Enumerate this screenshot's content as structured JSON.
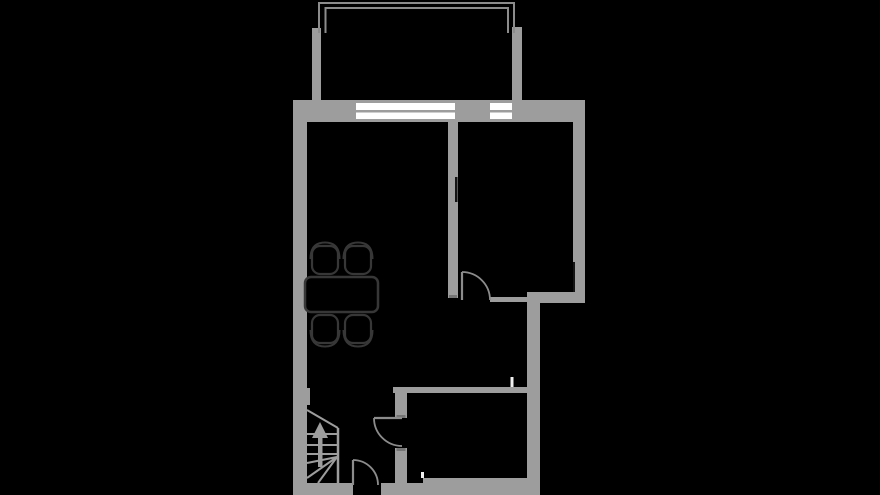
{
  "canvas": {
    "width": 880,
    "height": 495,
    "background": "#000000"
  },
  "colors": {
    "background": "#000000",
    "wall": "#9d9d9d",
    "wall_dark": "#757575",
    "line": "#8c8c8c",
    "furniture": "#373737",
    "furniture_fill": "#000000",
    "window": "#ffffff",
    "notch": "#141414",
    "tick": "#f0f0f0"
  },
  "floorplan": {
    "elements": [
      {
        "tag": "rect",
        "name": "wall-left-exterior",
        "attrs": {
          "x": 293,
          "y": 100,
          "width": 14,
          "height": 395,
          "fill": "@wall"
        }
      },
      {
        "tag": "rect",
        "name": "wall-top-left",
        "attrs": {
          "x": 293,
          "y": 100,
          "width": 63,
          "height": 22,
          "fill": "@wall"
        }
      },
      {
        "tag": "rect",
        "name": "window-living-frame",
        "attrs": {
          "x": 356,
          "y": 100,
          "width": 99,
          "height": 22,
          "fill": "@wall"
        }
      },
      {
        "tag": "rect",
        "name": "wall-top-middle",
        "attrs": {
          "x": 455,
          "y": 100,
          "width": 35,
          "height": 22,
          "fill": "@wall"
        }
      },
      {
        "tag": "rect",
        "name": "window-bedroom-frame",
        "attrs": {
          "x": 490,
          "y": 100,
          "width": 22,
          "height": 22,
          "fill": "@wall"
        }
      },
      {
        "tag": "rect",
        "name": "wall-top-right",
        "attrs": {
          "x": 512,
          "y": 100,
          "width": 73,
          "height": 22,
          "fill": "@wall"
        }
      },
      {
        "tag": "rect",
        "name": "wall-right-exterior",
        "attrs": {
          "x": 573,
          "y": 100,
          "width": 12,
          "height": 203,
          "fill": "@wall"
        }
      },
      {
        "tag": "rect",
        "name": "wall-bedroom-bottom",
        "attrs": {
          "x": 527,
          "y": 292,
          "width": 58,
          "height": 11,
          "fill": "@wall"
        }
      },
      {
        "tag": "rect",
        "name": "wall-right-lower-exterior",
        "attrs": {
          "x": 527,
          "y": 292,
          "width": 13,
          "height": 203,
          "fill": "@wall"
        }
      },
      {
        "tag": "rect",
        "name": "wall-bottom-left",
        "attrs": {
          "x": 293,
          "y": 483,
          "width": 60,
          "height": 12,
          "fill": "@wall"
        }
      },
      {
        "tag": "rect",
        "name": "wall-bottom-right",
        "attrs": {
          "x": 381,
          "y": 483,
          "width": 159,
          "height": 12,
          "fill": "@wall"
        }
      },
      {
        "tag": "rect",
        "name": "wall-bathroom-floor-edge",
        "attrs": {
          "x": 423,
          "y": 478,
          "width": 117,
          "height": 7,
          "fill": "@wall"
        }
      },
      {
        "tag": "rect",
        "name": "wall-middle-divider",
        "attrs": {
          "x": 448,
          "y": 122,
          "width": 10,
          "height": 176,
          "fill": "@wall"
        }
      },
      {
        "tag": "rect",
        "name": "wall-hall-bathroom",
        "attrs": {
          "x": 393,
          "y": 387,
          "width": 139,
          "height": 6,
          "fill": "@wall"
        }
      },
      {
        "tag": "rect",
        "name": "wall-bathroom-door-stub-upper",
        "attrs": {
          "x": 395,
          "y": 393,
          "width": 12,
          "height": 25,
          "fill": "@wall"
        }
      },
      {
        "tag": "rect",
        "name": "wall-bathroom-door-stub-lower",
        "attrs": {
          "x": 395,
          "y": 448,
          "width": 12,
          "height": 35,
          "fill": "@wall"
        }
      },
      {
        "tag": "rect",
        "name": "wall-pilaster-left",
        "attrs": {
          "x": 307,
          "y": 388,
          "width": 3,
          "height": 17,
          "fill": "@wall"
        }
      },
      {
        "tag": "rect",
        "name": "balcony-wall-left",
        "attrs": {
          "x": 312,
          "y": 28,
          "width": 9,
          "height": 72,
          "fill": "@wall"
        }
      },
      {
        "tag": "rect",
        "name": "balcony-wall-right",
        "attrs": {
          "x": 512,
          "y": 27,
          "width": 10,
          "height": 73,
          "fill": "@wall"
        }
      },
      {
        "tag": "rect",
        "name": "wall-bedroom-thin-segment",
        "attrs": {
          "x": 490,
          "y": 297,
          "width": 37,
          "height": 5,
          "fill": "@wall"
        }
      },
      {
        "tag": "rect",
        "name": "door-jamb-cap-upper",
        "attrs": {
          "x": 396.5,
          "y": 415,
          "width": 9,
          "height": 3,
          "fill": "@wall_dark"
        }
      },
      {
        "tag": "rect",
        "name": "door-jamb-cap-lower",
        "attrs": {
          "x": 396.5,
          "y": 448,
          "width": 9,
          "height": 3,
          "fill": "@wall_dark"
        }
      },
      {
        "tag": "rect",
        "name": "door-jamb-cap-bedroom",
        "attrs": {
          "x": 449,
          "y": 295,
          "width": 8,
          "height": 3,
          "fill": "@wall_dark"
        }
      },
      {
        "tag": "rect",
        "name": "window-living-pane-top",
        "attrs": {
          "x": 356,
          "y": 103,
          "width": 99,
          "height": 7,
          "fill": "@window"
        }
      },
      {
        "tag": "rect",
        "name": "window-living-pane-bottom",
        "attrs": {
          "x": 356,
          "y": 112.5,
          "width": 99,
          "height": 6.5,
          "fill": "@window"
        }
      },
      {
        "tag": "rect",
        "name": "window-bedroom-pane-top",
        "attrs": {
          "x": 490,
          "y": 103,
          "width": 22,
          "height": 7,
          "fill": "@window"
        }
      },
      {
        "tag": "rect",
        "name": "window-bedroom-pane-bottom",
        "attrs": {
          "x": 490,
          "y": 112.5,
          "width": 22,
          "height": 6.5,
          "fill": "@window"
        }
      },
      {
        "tag": "rect",
        "name": "balcony-railing-top-outer",
        "attrs": {
          "x": 318,
          "y": 2,
          "width": 197,
          "height": 2,
          "fill": "@line"
        }
      },
      {
        "tag": "rect",
        "name": "balcony-railing-top-inner",
        "attrs": {
          "x": 325,
          "y": 7,
          "width": 184,
          "height": 2,
          "fill": "@line"
        }
      },
      {
        "tag": "rect",
        "name": "balcony-railing-left-outer",
        "attrs": {
          "x": 318,
          "y": 2,
          "width": 2,
          "height": 31,
          "fill": "@line"
        }
      },
      {
        "tag": "rect",
        "name": "balcony-railing-left-inner",
        "attrs": {
          "x": 324.5,
          "y": 7,
          "width": 2,
          "height": 26,
          "fill": "@line"
        }
      },
      {
        "tag": "rect",
        "name": "balcony-railing-right-outer",
        "attrs": {
          "x": 513,
          "y": 2,
          "width": 2,
          "height": 31,
          "fill": "@line"
        }
      },
      {
        "tag": "rect",
        "name": "balcony-railing-right-inner",
        "attrs": {
          "x": 507,
          "y": 7,
          "width": 2,
          "height": 26,
          "fill": "@line"
        }
      },
      {
        "tag": "rect",
        "name": "wall-notch-middle",
        "attrs": {
          "x": 455,
          "y": 177,
          "width": 2.5,
          "height": 25,
          "fill": "@notch"
        }
      },
      {
        "tag": "rect",
        "name": "wall-notch-right",
        "attrs": {
          "x": 573,
          "y": 262,
          "width": 2,
          "height": 30,
          "fill": "@notch"
        }
      },
      {
        "tag": "rect",
        "name": "wall-marker-upper",
        "attrs": {
          "x": 510.5,
          "y": 377,
          "width": 3,
          "height": 10,
          "fill": "@tick"
        }
      },
      {
        "tag": "rect",
        "name": "wall-marker-lower",
        "attrs": {
          "x": 421,
          "y": 472,
          "width": 3,
          "height": 6,
          "fill": "@tick"
        }
      },
      {
        "tag": "line",
        "name": "bedroom-door-leaf",
        "attrs": {
          "x1": 462,
          "y1": 272,
          "x2": 462,
          "y2": 300,
          "stroke": "@line",
          "stroke-width": 2.2
        }
      },
      {
        "tag": "path",
        "name": "bedroom-door-swing",
        "attrs": {
          "d": "M462,272 A28,28 0 0 1 490,300",
          "fill": "none",
          "stroke": "@line",
          "stroke-width": 1.8
        }
      },
      {
        "tag": "line",
        "name": "bathroom-door-leaf",
        "attrs": {
          "x1": 374,
          "y1": 418,
          "x2": 402,
          "y2": 418,
          "stroke": "@line",
          "stroke-width": 2.2
        }
      },
      {
        "tag": "path",
        "name": "bathroom-door-swing",
        "attrs": {
          "d": "M374,418 A28,28 0 0 0 402,446",
          "fill": "none",
          "stroke": "@line",
          "stroke-width": 1.8
        }
      },
      {
        "tag": "line",
        "name": "entry-door-leaf",
        "attrs": {
          "x1": 353,
          "y1": 460,
          "x2": 353,
          "y2": 485,
          "stroke": "@line",
          "stroke-width": 2.2
        }
      },
      {
        "tag": "path",
        "name": "entry-door-swing",
        "attrs": {
          "d": "M353,460 A25,25 0 0 1 378,485",
          "fill": "none",
          "stroke": "@line",
          "stroke-width": 1.8
        }
      },
      {
        "tag": "line",
        "name": "stairs-edge-diagonal",
        "attrs": {
          "x1": 307,
          "y1": 410,
          "x2": 338,
          "y2": 428,
          "stroke": "@wall",
          "stroke-width": 2
        }
      },
      {
        "tag": "line",
        "name": "stairs-edge-right",
        "attrs": {
          "x1": 338,
          "y1": 428,
          "x2": 338,
          "y2": 483,
          "stroke": "@wall",
          "stroke-width": 2.5
        }
      },
      {
        "tag": "line",
        "name": "stairs-tread-1",
        "attrs": {
          "x1": 307,
          "y1": 434,
          "x2": 338,
          "y2": 434,
          "stroke": "@wall",
          "stroke-width": 2
        }
      },
      {
        "tag": "line",
        "name": "stairs-tread-2",
        "attrs": {
          "x1": 307,
          "y1": 445,
          "x2": 338,
          "y2": 445,
          "stroke": "@wall",
          "stroke-width": 2
        }
      },
      {
        "tag": "line",
        "name": "stairs-tread-3",
        "attrs": {
          "x1": 307,
          "y1": 454,
          "x2": 338,
          "y2": 454,
          "stroke": "@wall",
          "stroke-width": 2
        }
      },
      {
        "tag": "line",
        "name": "stairs-winder-1",
        "attrs": {
          "x1": 337,
          "y1": 457,
          "x2": 307,
          "y2": 463,
          "stroke": "@wall",
          "stroke-width": 2
        }
      },
      {
        "tag": "line",
        "name": "stairs-winder-2",
        "attrs": {
          "x1": 337,
          "y1": 457,
          "x2": 307,
          "y2": 478,
          "stroke": "@wall",
          "stroke-width": 2
        }
      },
      {
        "tag": "line",
        "name": "stairs-winder-3",
        "attrs": {
          "x1": 337,
          "y1": 457,
          "x2": 318,
          "y2": 483,
          "stroke": "@wall",
          "stroke-width": 2
        }
      },
      {
        "tag": "polygon",
        "name": "stairs-direction-arrow-head",
        "attrs": {
          "points": "320,422 312,438 328,438",
          "fill": "@wall"
        }
      },
      {
        "tag": "rect",
        "name": "stairs-direction-arrow-shaft",
        "attrs": {
          "x": 318,
          "y": 437,
          "width": 4.5,
          "height": 30,
          "fill": "@wall"
        }
      },
      {
        "tag": "rect",
        "name": "dining-table",
        "attrs": {
          "x": 305,
          "y": 277,
          "width": 73,
          "height": 35,
          "rx": 6,
          "fill": "@furniture_fill",
          "stroke": "@furniture",
          "stroke-width": 2.5
        }
      },
      {
        "tag": "path",
        "name": "chair-backrest-top-left",
        "attrs": {
          "d": "M310.5,259 Q310.5,242.5 325,242.5 Q339.5,242.5 339.5,259",
          "fill": "none",
          "stroke": "@furniture",
          "stroke-width": 2
        }
      },
      {
        "tag": "path",
        "name": "chair-backrest-top-right",
        "attrs": {
          "d": "M343.5,259 Q343.5,242.5 358,242.5 Q372.5,242.5 372.5,259",
          "fill": "none",
          "stroke": "@furniture",
          "stroke-width": 2
        }
      },
      {
        "tag": "path",
        "name": "chair-backrest-bottom-left",
        "attrs": {
          "d": "M310.5,330 Q310.5,346.5 325,346.5 Q339.5,346.5 339.5,330",
          "fill": "none",
          "stroke": "@furniture",
          "stroke-width": 2
        }
      },
      {
        "tag": "path",
        "name": "chair-backrest-bottom-right",
        "attrs": {
          "d": "M343.5,330 Q343.5,346.5 358,346.5 Q372.5,346.5 372.5,330",
          "fill": "none",
          "stroke": "@furniture",
          "stroke-width": 2
        }
      },
      {
        "tag": "rect",
        "name": "chair-seat-top-left",
        "attrs": {
          "x": 312,
          "y": 246,
          "width": 26,
          "height": 28,
          "rx": 8,
          "fill": "@furniture_fill",
          "stroke": "@furniture",
          "stroke-width": 2.2
        }
      },
      {
        "tag": "rect",
        "name": "chair-seat-top-right",
        "attrs": {
          "x": 345,
          "y": 246,
          "width": 26,
          "height": 28,
          "rx": 8,
          "fill": "@furniture_fill",
          "stroke": "@furniture",
          "stroke-width": 2.2
        }
      },
      {
        "tag": "rect",
        "name": "chair-seat-bottom-left",
        "attrs": {
          "x": 312,
          "y": 315,
          "width": 26,
          "height": 28,
          "rx": 8,
          "fill": "@furniture_fill",
          "stroke": "@furniture",
          "stroke-width": 2.2
        }
      },
      {
        "tag": "rect",
        "name": "chair-seat-bottom-right",
        "attrs": {
          "x": 345,
          "y": 315,
          "width": 26,
          "height": 28,
          "rx": 8,
          "fill": "@furniture_fill",
          "stroke": "@furniture",
          "stroke-width": 2.2
        }
      }
    ]
  }
}
